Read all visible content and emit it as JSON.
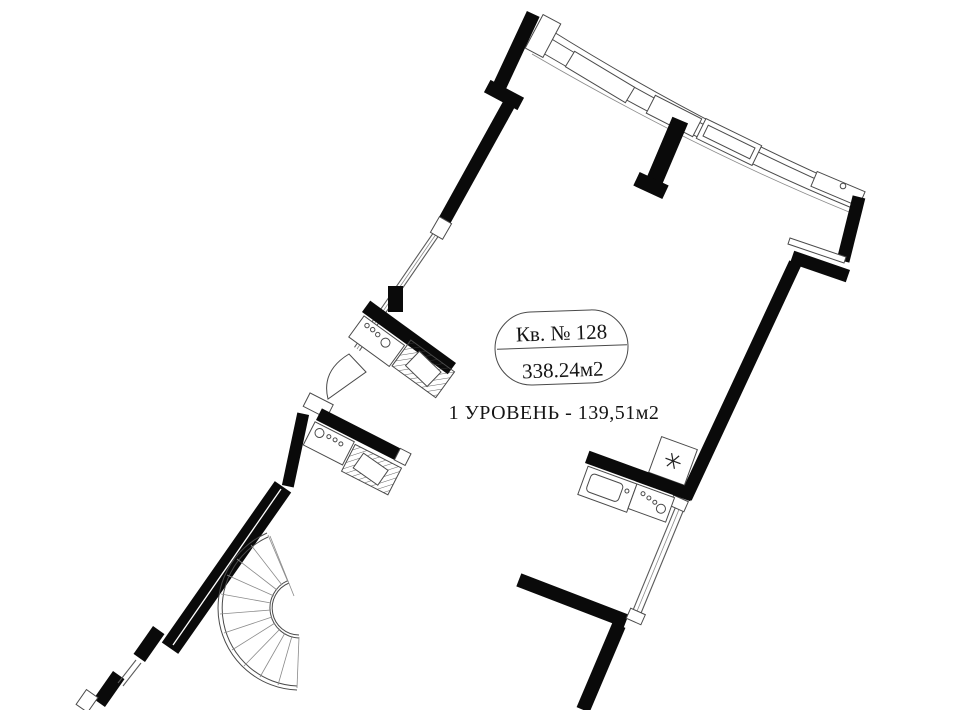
{
  "plan": {
    "apartment_label": {
      "line1": "Кв. № 128",
      "line2": "338.24м2"
    },
    "level_label": "1 УРОВЕНЬ - 139,51м2"
  },
  "icons": {
    "refrigerator": "six-spoke-asterisk-snowflake"
  },
  "colors": {
    "background": "#ffffff",
    "wall": "#0a0a0a",
    "thin_line": "#4a4a4a",
    "glazing": "#5a5a5a"
  }
}
